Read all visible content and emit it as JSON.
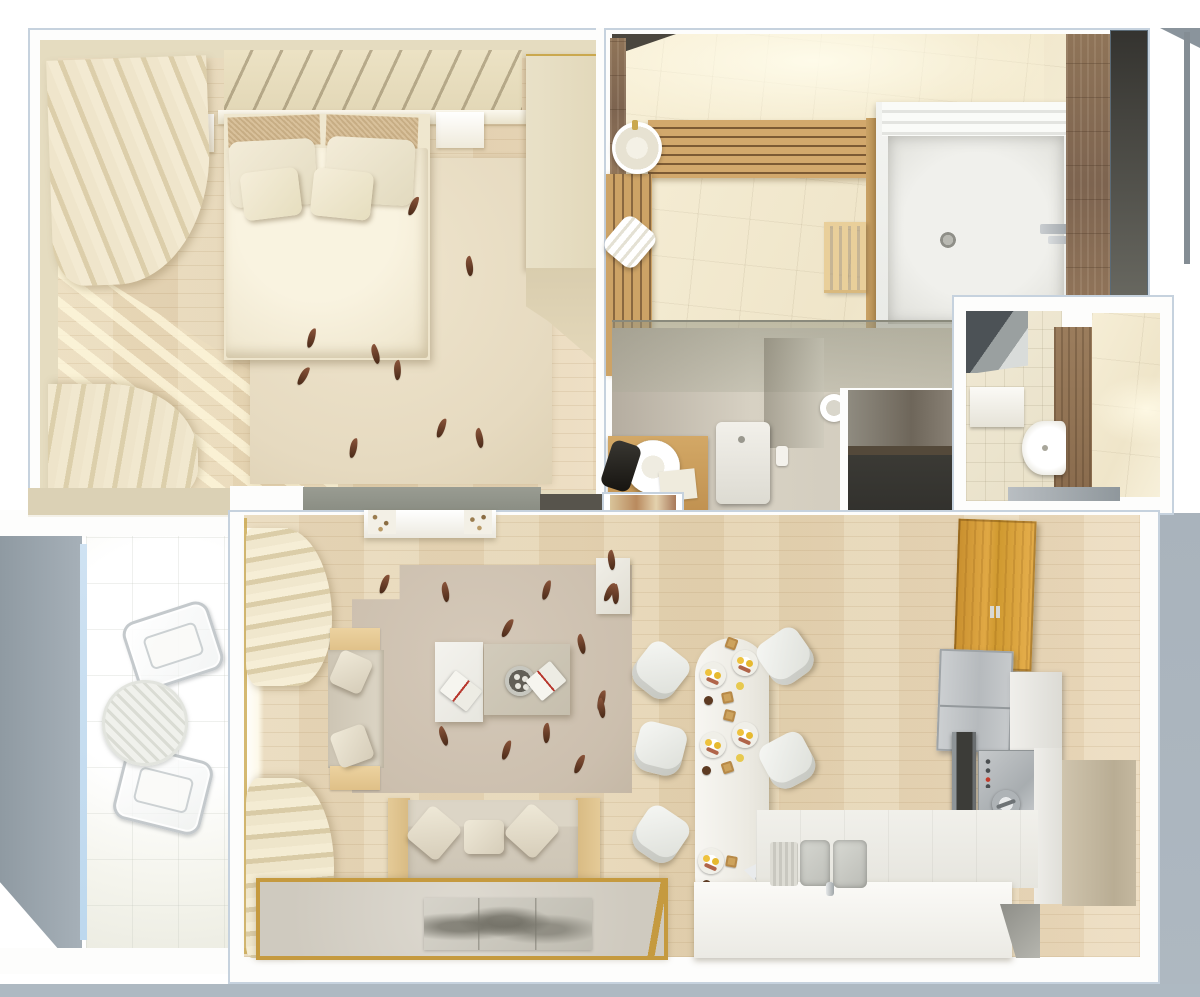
{
  "scene": {
    "title": "Top-view 3D render of a one-bedroom apartment interior",
    "render_style": "photorealistic bird's-eye floor plan, warm beige palette, no visible text",
    "rooms": [
      {
        "id": "bedroom",
        "label": "Bedroom",
        "position": "top-left",
        "items": [
          "double bed with white duvet",
          "two tan headboard cushions",
          "two large white pillows",
          "two small square cushions",
          "diagonal slatted headboard wall",
          "left nightstand with open book",
          "right nightstand",
          "sheer curtains with streaming sunlight",
          "beige rug with leaf motifs",
          "tall wardrobe on right wall",
          "round ottoman"
        ]
      },
      {
        "id": "bathroom",
        "label": "Bathroom / sauna",
        "position": "top-right",
        "items": [
          "round countertop washbasin",
          "horizontal wooden bench slats",
          "vertical wooden bench",
          "rolled white towel",
          "wooden towel radiator",
          "large white shower tray with drain",
          "brown mosaic tile wall",
          "dark wardrobe panel",
          "glass partition",
          "wooden vanity with round vessel sink",
          "dark towel",
          "toilet with cistern",
          "round drain stool"
        ]
      },
      {
        "id": "entry-hall",
        "label": "Entry hall",
        "position": "center-right seam",
        "items": [
          "charcoal floor mat",
          "framed doormat inset"
        ]
      },
      {
        "id": "wc",
        "label": "Guest WC",
        "position": "right-middle",
        "items": [
          "corner mirror reflection",
          "wall shelf cistern",
          "semicircular wall-hung basin",
          "wood-tile accent strip",
          "cream ceramic tiles",
          "gray threshold"
        ]
      },
      {
        "id": "living-room",
        "label": "Living room",
        "position": "bottom-left-of-center",
        "items": [
          "window wall with two ruffled curtains",
          "floating wall shelf with trinkets",
          "loveseat with two wooden side consoles and two cushions",
          "white coffee table with open book",
          "beige coffee table with round serving tray and book",
          "large beige rug with scattered leaf motifs",
          "three-seat sofa with oak armrests and three pillows",
          "light rug with gold border and grayscale art print",
          "small white cabinet with leaf"
        ]
      },
      {
        "id": "dining-area",
        "label": "Dining area",
        "position": "bottom-center",
        "items": [
          "white pill-shaped dining table",
          "five white molded chairs",
          "three breakfast settings with fried eggs, bacon, toast and cookies",
          "metal scoop"
        ]
      },
      {
        "id": "kitchen",
        "label": "Kitchen",
        "position": "bottom-right",
        "items": [
          "golden oak wall cabinet",
          "stainless two-door fridge",
          "tall white cabinet",
          "built-in dark oven",
          "stainless cooktop with control knob",
          "white control module",
          "double sink with drainboard and faucet",
          "L-shaped white counter and island"
        ]
      },
      {
        "id": "balcony",
        "label": "Balcony",
        "position": "left",
        "items": [
          "gray concrete side slab",
          "sky-blue glazing sliver",
          "white tiled floor",
          "two chrome-frame chairs",
          "round slatted bistro table"
        ]
      }
    ],
    "counts": {
      "dining_chairs": 5,
      "breakfast_settings": 3,
      "balcony_chairs": 2,
      "sofa_pillows": 3,
      "leaf_motifs_living": 11,
      "leaf_motifs_bedroom": 9
    },
    "palette": {
      "page_background": "#ffffff",
      "wood_floor": "#e7d7ba",
      "cream_wall": "#e5dcc0",
      "outside_gray": "#a7b1ba",
      "concrete_slab": "#97a1a9",
      "sky_blue_sliver": "#cfe2f2",
      "bench_wood": "#cfa368",
      "brown_tile": "#8d7258",
      "charcoal": "#3b3a35",
      "gold_accent": "#c59a3f",
      "kitchen_cabinet_wood": "#d09a3c",
      "stainless": "#c0c4c6",
      "duvet_white": "#f6efdb",
      "rug_beige": "#cfc2b2",
      "leaf_brown": "#6b4632"
    }
  }
}
